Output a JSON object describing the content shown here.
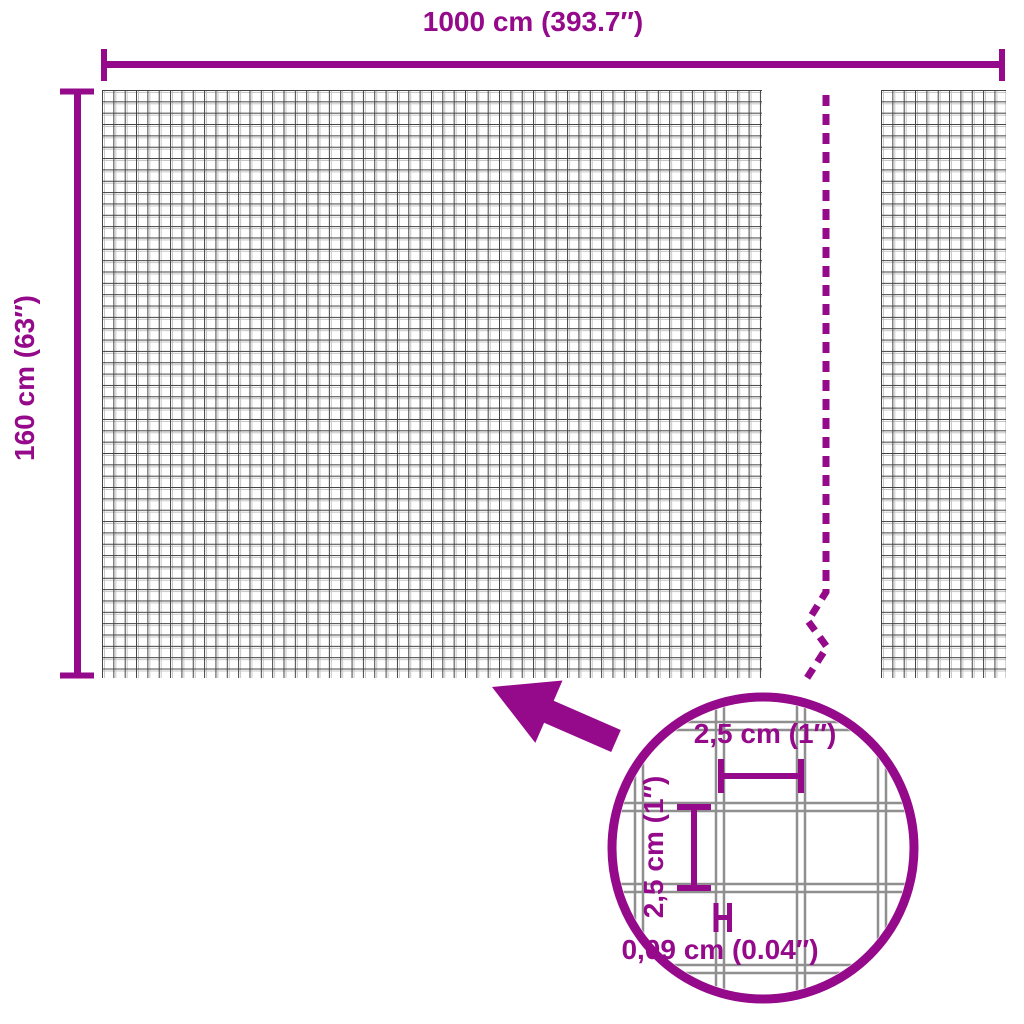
{
  "colors": {
    "accent_purple": "#95098B",
    "mesh_wire_dark": "#414141",
    "mesh_wire_light": "#c6c6c6",
    "detail_wire_gray": "#8f8f8f"
  },
  "overall_dimensions": {
    "width_label": "1000 cm (393.7″)",
    "height_label": "160 cm (63″)"
  },
  "detail_view": {
    "cell_width_label": "2,5 cm (1″)",
    "cell_height_label": "2,5 cm (1″)",
    "wire_thickness_label": "0,09 cm (0.04″)"
  }
}
